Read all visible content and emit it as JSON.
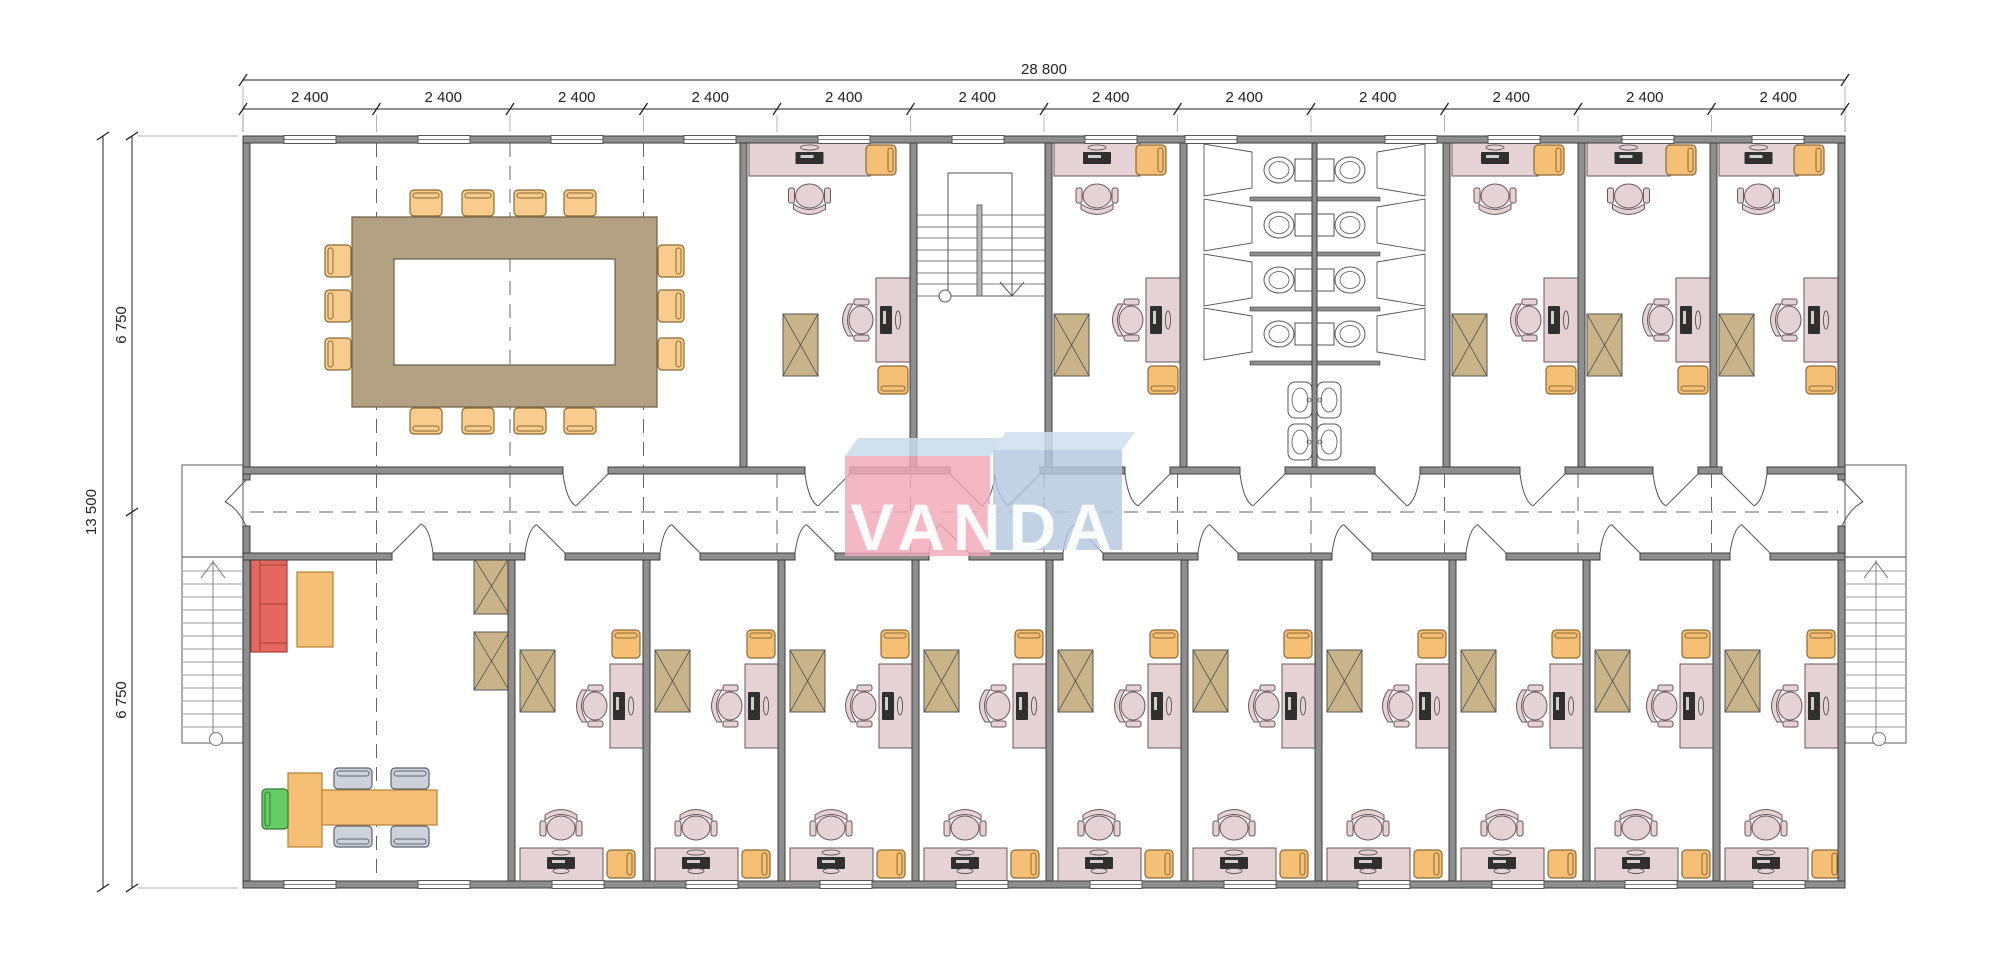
{
  "title": "VANDA modular office building - floor plan",
  "logo": {
    "text": "VANDA"
  },
  "dimensions": {
    "overall_width": "28 800",
    "bays": [
      "2 400",
      "2 400",
      "2 400",
      "2 400",
      "2 400",
      "2 400",
      "2 400",
      "2 400",
      "2 400",
      "2 400",
      "2 400",
      "2 400"
    ],
    "overall_height": "13 500",
    "halves": [
      "6 750",
      "6 750"
    ]
  },
  "colors": {
    "background": "#ffffff",
    "wall": "#8e8e8e",
    "wall_edge": "#3f3f3f",
    "line": "#555555",
    "thin": "#777777",
    "dim": "#222222",
    "desk": "#e5d2d5",
    "desk_edge": "#6a575b",
    "chair_orange": "#f5bf75",
    "chair_orange_edge": "#8a6a35",
    "conf_table": "#b2a182",
    "conf_table_edge": "#6d5f4b",
    "conf_chair": "#f7cc8d",
    "cabinet": "#c9b489",
    "sofa": "#e3685f",
    "sofa_edge": "#a93c34",
    "sofa_back": "#8ab7b7",
    "table_orange": "#f5bf75",
    "table_orange_edge": "#b5813a",
    "chair_green": "#67cb67",
    "chair_green_edge": "#2f7d2f",
    "chair_gray": "#cdd1d9",
    "chair_gray_edge": "#5f646e",
    "fixture": "#ffffff",
    "monitor": "#303030",
    "logo_pink": "rgba(242,168,184,0.82)",
    "logo_pink_top": "rgba(200,218,234,0.85)",
    "logo_blue": "rgba(181,200,222,0.82)",
    "logo_blue_top": "rgba(207,223,238,0.85)",
    "logo_text": "#ffffff"
  },
  "rooms": {
    "top": [
      "conference-room",
      "office",
      "stair-hall",
      "office",
      "wc-left",
      "wc-right",
      "office",
      "office",
      "office"
    ],
    "bottom": [
      "reception-office",
      "office",
      "office",
      "office",
      "office",
      "office",
      "office",
      "office",
      "office",
      "office",
      "office"
    ]
  }
}
